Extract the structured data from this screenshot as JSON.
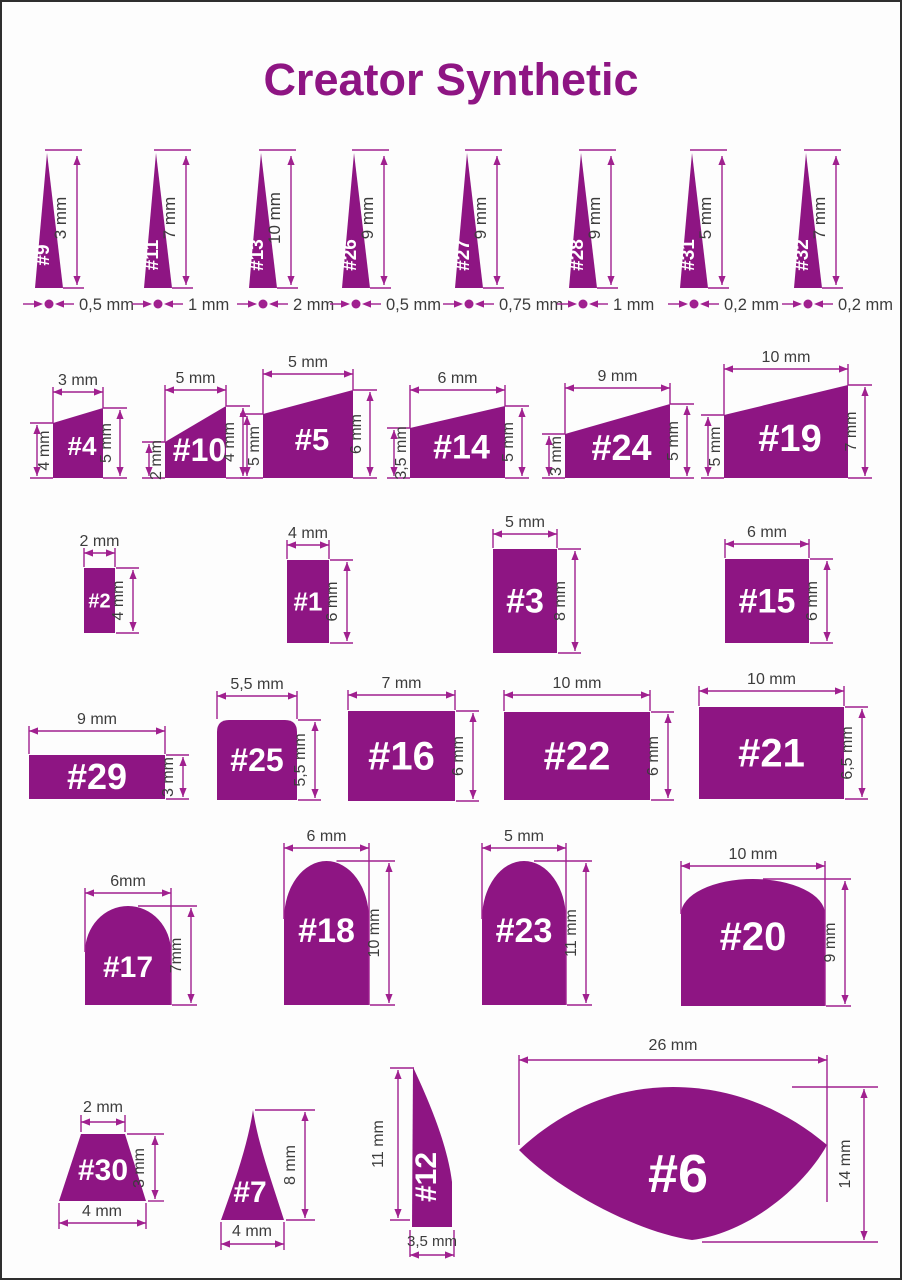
{
  "title": "Creator Synthetic",
  "colors": {
    "shape": "#8e1583",
    "dimension_line": "#a0208f",
    "dimension_text": "#3c3c3c",
    "title": "#8e1583",
    "shape_label": "#ffffff",
    "background": "#fdfdfd",
    "border": "#2e2e2e"
  },
  "unit": "mm",
  "brushes": [
    {
      "id": "9",
      "label": "#9",
      "type": "spike",
      "height": "3 mm",
      "width": "0,5 mm"
    },
    {
      "id": "11",
      "label": "#11",
      "type": "spike",
      "height": "7 mm",
      "width": "1 mm"
    },
    {
      "id": "13",
      "label": "#13",
      "type": "spike",
      "height": "10 mm",
      "width": "2 mm"
    },
    {
      "id": "26",
      "label": "#26",
      "type": "spike",
      "height": "9 mm",
      "width": "0,5 mm"
    },
    {
      "id": "27",
      "label": "#27",
      "type": "spike",
      "height": "9 mm",
      "width": "0,75 mm"
    },
    {
      "id": "28",
      "label": "#28",
      "type": "spike",
      "height": "9 mm",
      "width": "1 mm"
    },
    {
      "id": "31",
      "label": "#31",
      "type": "spike",
      "height": "5 mm",
      "width": "0,2 mm"
    },
    {
      "id": "32",
      "label": "#32",
      "type": "spike",
      "height": "7 mm",
      "width": "0,2 mm"
    },
    {
      "id": "4",
      "label": "#4",
      "type": "slant",
      "top": "3 mm",
      "left": "4 mm",
      "right": "5 mm"
    },
    {
      "id": "10",
      "label": "#10",
      "type": "slant",
      "top": "5 mm",
      "left": "2 mm",
      "right": "4 mm"
    },
    {
      "id": "5",
      "label": "#5",
      "type": "slant",
      "top": "5 mm",
      "left": "5 mm",
      "right": "6 mm"
    },
    {
      "id": "14",
      "label": "#14",
      "type": "slant",
      "top": "6 mm",
      "left": "3,5 mm",
      "right": "5 mm"
    },
    {
      "id": "24",
      "label": "#24",
      "type": "slant",
      "top": "9 mm",
      "left": "3 mm",
      "right": "5 mm"
    },
    {
      "id": "19",
      "label": "#19",
      "type": "slant",
      "top": "10 mm",
      "left": "5 mm",
      "right": "7 mm"
    },
    {
      "id": "2",
      "label": "#2",
      "type": "rect",
      "top": "2 mm",
      "right": "4 mm"
    },
    {
      "id": "1",
      "label": "#1",
      "type": "rect",
      "top": "4 mm",
      "right": "6 mm"
    },
    {
      "id": "3",
      "label": "#3",
      "type": "rect",
      "top": "5 mm",
      "right": "8 mm"
    },
    {
      "id": "15",
      "label": "#15",
      "type": "rect",
      "top": "6 mm",
      "right": "6 mm"
    },
    {
      "id": "29",
      "label": "#29",
      "type": "rect",
      "top": "9 mm",
      "right": "3 mm"
    },
    {
      "id": "25",
      "label": "#25",
      "type": "rect",
      "top": "5,5 mm",
      "right": "5,5 mm"
    },
    {
      "id": "16",
      "label": "#16",
      "type": "rect",
      "top": "7 mm",
      "right": "6 mm"
    },
    {
      "id": "22",
      "label": "#22",
      "type": "rect",
      "top": "10 mm",
      "right": "6 mm"
    },
    {
      "id": "21",
      "label": "#21",
      "type": "rect",
      "top": "10 mm",
      "right": "6,5 mm"
    },
    {
      "id": "17",
      "label": "#17",
      "type": "dome",
      "top": "6mm",
      "right": "7mm"
    },
    {
      "id": "18",
      "label": "#18",
      "type": "dome",
      "top": "6 mm",
      "right": "10 mm"
    },
    {
      "id": "23",
      "label": "#23",
      "type": "dome",
      "top": "5 mm",
      "right": "11 mm"
    },
    {
      "id": "20",
      "label": "#20",
      "type": "dome",
      "top": "10 mm",
      "right": "9 mm"
    },
    {
      "id": "30",
      "label": "#30",
      "type": "trapezoid",
      "top": "2 mm",
      "bottom": "4 mm",
      "right": "3 mm"
    },
    {
      "id": "7",
      "label": "#7",
      "type": "flame",
      "bottom": "4 mm",
      "right": "8 mm"
    },
    {
      "id": "12",
      "label": "#12",
      "type": "blade",
      "left": "11 mm",
      "bottom": "3,5 mm"
    },
    {
      "id": "6",
      "label": "#6",
      "type": "fan",
      "top": "26 mm",
      "right": "14 mm"
    }
  ]
}
